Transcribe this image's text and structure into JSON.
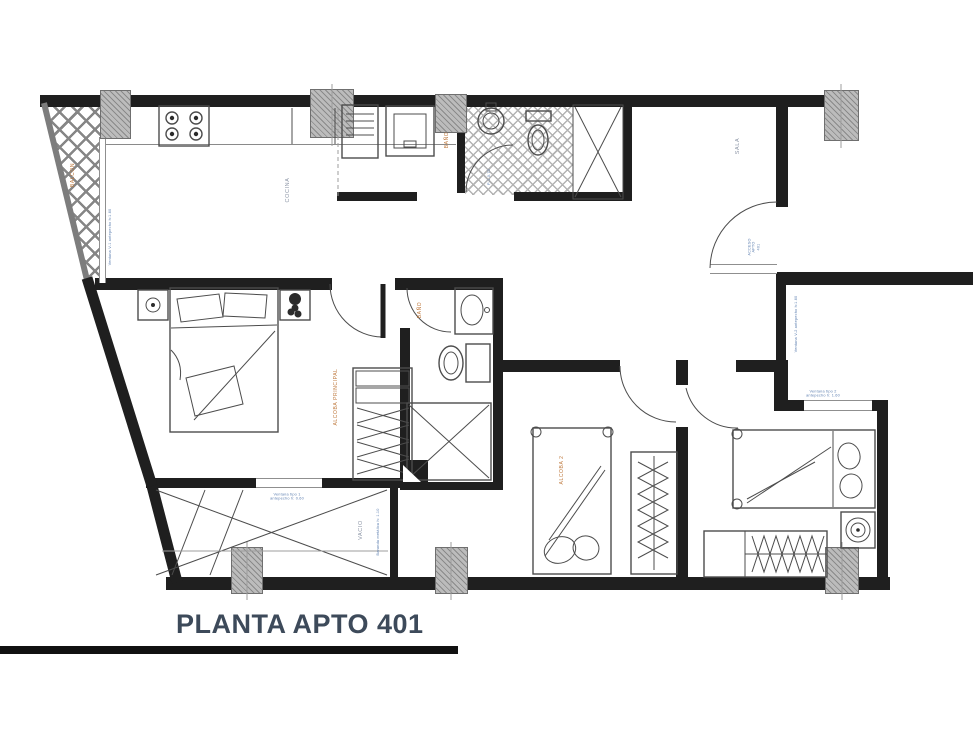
{
  "title": "PLANTA APTO 401",
  "colors": {
    "background": "#ffffff",
    "wall": "#1f1f1f",
    "furniture_line": "#4c4c4c",
    "light_line": "#9c9c9c",
    "column_fill": "#bcbcbc",
    "room_label": "#8b94a5",
    "area_label": "#bf7a3f",
    "annotation": "#5d7fb0",
    "title": "#3d4a5a"
  },
  "labels": {
    "balcon": "BALCON",
    "cocina": "COCINA",
    "bano_social": "BAÑO",
    "sala": "SALA",
    "acceso_line1": "ACCESO",
    "acceso_line2": "APTO",
    "acceso_line3": "401",
    "alcoba_principal": "ALCOBA PRINCIPAL",
    "bano_privado": "BAÑO",
    "alcoba_2": "ALCOBA 2",
    "vacio": "VACIO"
  },
  "annotations": {
    "ventana_balcon": "Ventana V-1 antepecho h:1.60",
    "puerta_bano": "P-1 0.70",
    "ventana_alcoba_ppal_l1": "Ventana tipo 1",
    "ventana_alcoba_ppal_l2": "antepecho h: 0.60",
    "baranda_vacio": "Baranda metálica h: 1.10",
    "ventana_corredor": "Ventana V-2 antepecho h:1.60",
    "ventana_alcoba3_l1": "Ventana tipo 2",
    "ventana_alcoba3_l2": "antepecho h: 1.60"
  }
}
